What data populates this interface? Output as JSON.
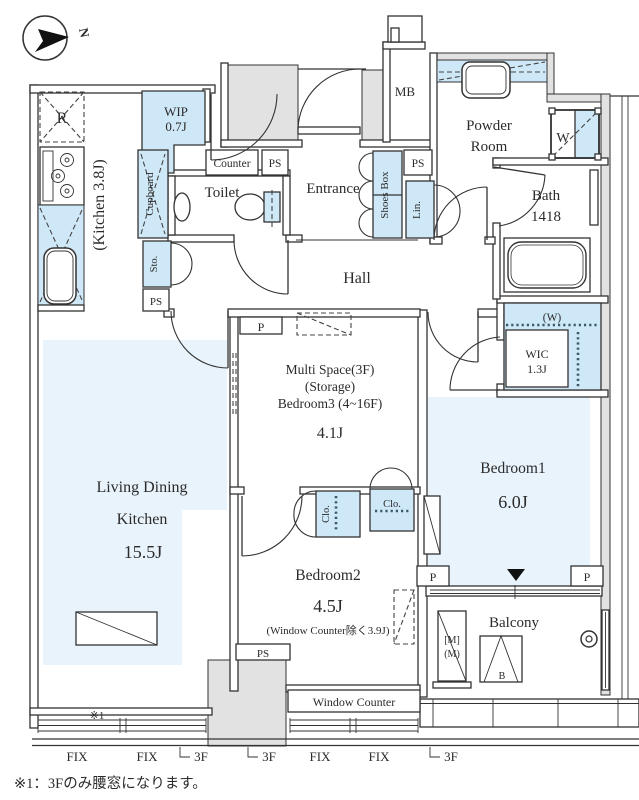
{
  "title": "Floor Plan",
  "colors": {
    "fixture_blue": "#cfe8f7",
    "floor_blue": "#e9f3fb",
    "wall_gray": "#e2e2e2",
    "line": "#333333"
  },
  "compass": {
    "north": "N"
  },
  "rooms": {
    "kitchen": {
      "label": "(Kitchen 3.8J)"
    },
    "wip": {
      "name": "WIP",
      "size": "0.7J"
    },
    "toilet": {
      "name": "Toilet"
    },
    "entrance": {
      "name": "Entrance"
    },
    "hall": {
      "name": "Hall"
    },
    "mb": {
      "name": "MB"
    },
    "powder_room": {
      "line1": "Powder",
      "line2": "Room"
    },
    "bath": {
      "name": "Bath",
      "size": "1418"
    },
    "wic": {
      "w_mark": "(W)",
      "name": "WIC",
      "size": "1.3J"
    },
    "multi_space": {
      "line1": "Multi Space(3F)",
      "line2": "(Storage)",
      "line3": "Bedroom3 (4~16F)",
      "size": "4.1J"
    },
    "bedroom1": {
      "name": "Bedroom1",
      "size": "6.0J"
    },
    "bedroom2": {
      "name": "Bedroom2",
      "size": "4.5J",
      "note": "(Window Counter除く3.9J)"
    },
    "ldk": {
      "line1": "Living Dining",
      "line2": "Kitchen",
      "size": "15.5J"
    },
    "balcony": {
      "name": "Balcony"
    },
    "window_counter": {
      "name": "Window Counter"
    }
  },
  "fixtures": {
    "refrigerator": "R",
    "counter": "Counter",
    "cupboard": "Cupboard",
    "shoes_box": "Shoes Box",
    "linen": "Lin.",
    "storage": "Sto.",
    "washer": "W",
    "closet": "Clo.",
    "pipe_space": "PS",
    "pillar": "P",
    "meter_line1": "[M]",
    "meter_line2": "(M)",
    "boiler": "B"
  },
  "annotations": {
    "note_mark": "※1",
    "footnote": "※1：3Fのみ腰窓になります。",
    "fix_window": "FIX",
    "floor3_window": "3F"
  }
}
